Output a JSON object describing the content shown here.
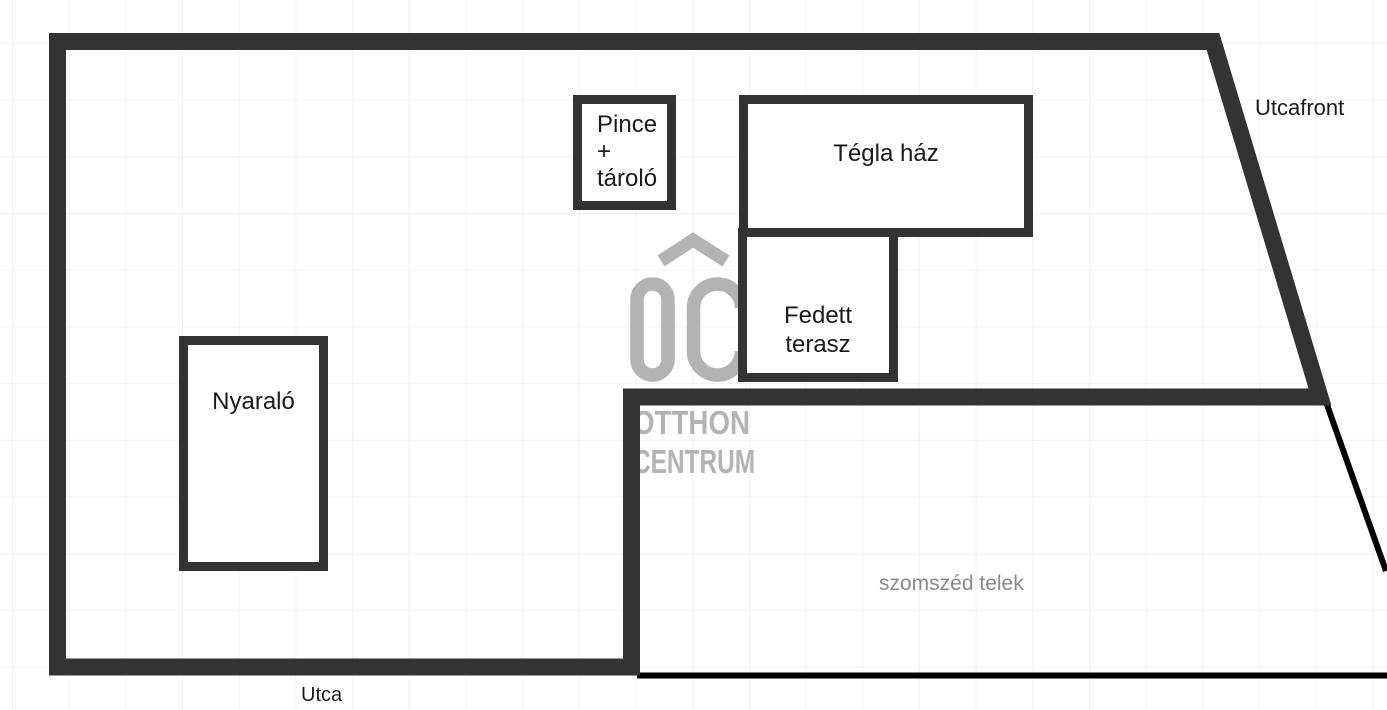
{
  "plan": {
    "buildings": {
      "pince_tarolo": {
        "lines": [
          "Pince",
          "+",
          "tároló"
        ]
      },
      "tegla_haz": {
        "label": "Tégla ház"
      },
      "fedett_terasz": {
        "lines": [
          "Fedett",
          "terasz"
        ]
      },
      "nyaralo": {
        "label": "Nyaraló"
      }
    },
    "labels": {
      "utcafront": "Utcafront",
      "szomszed_telek": "szomszéd telek",
      "utca": "Utca"
    },
    "watermark": {
      "logo_text": "OC",
      "line1": "OTTHON",
      "line2": "CENTRUM"
    },
    "colors": {
      "background": "#ffffff",
      "grid": "#f2f2f2",
      "plot_boundary": "#333333",
      "building_border": "#333333",
      "thin_line": "#000000",
      "text": "#1a1a1a",
      "muted_text": "#8a8a8a",
      "watermark": "#b3b3b3"
    }
  }
}
